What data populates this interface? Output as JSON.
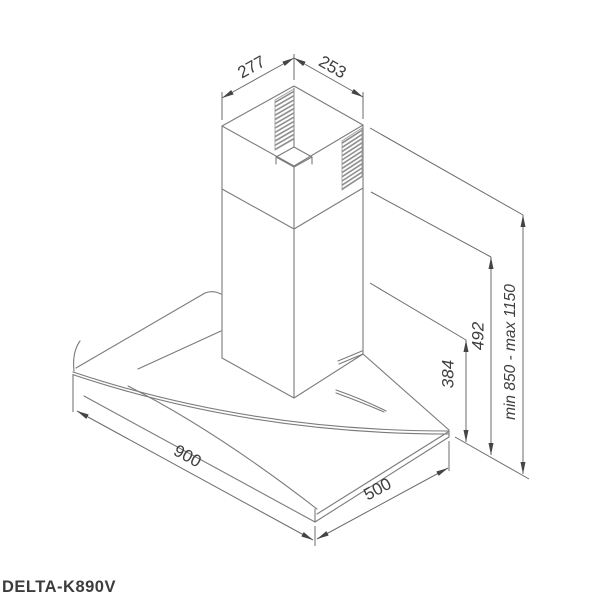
{
  "drawing": {
    "product_label": "DELTA-K890V",
    "type": "range-hood installation dimension drawing",
    "dimensions": {
      "top_width": "277",
      "top_depth": "253",
      "duct_section_height": "384",
      "chimney_section_height": "492",
      "mounting_height_range": "min 850 - max 1150",
      "body_width": "900",
      "body_depth": "500"
    },
    "colors": {
      "line": "#7b7b7b",
      "dimension_line": "#6b6b6b",
      "arrow": "#454545",
      "text": "#3e3e3e",
      "background": "#ffffff"
    }
  }
}
